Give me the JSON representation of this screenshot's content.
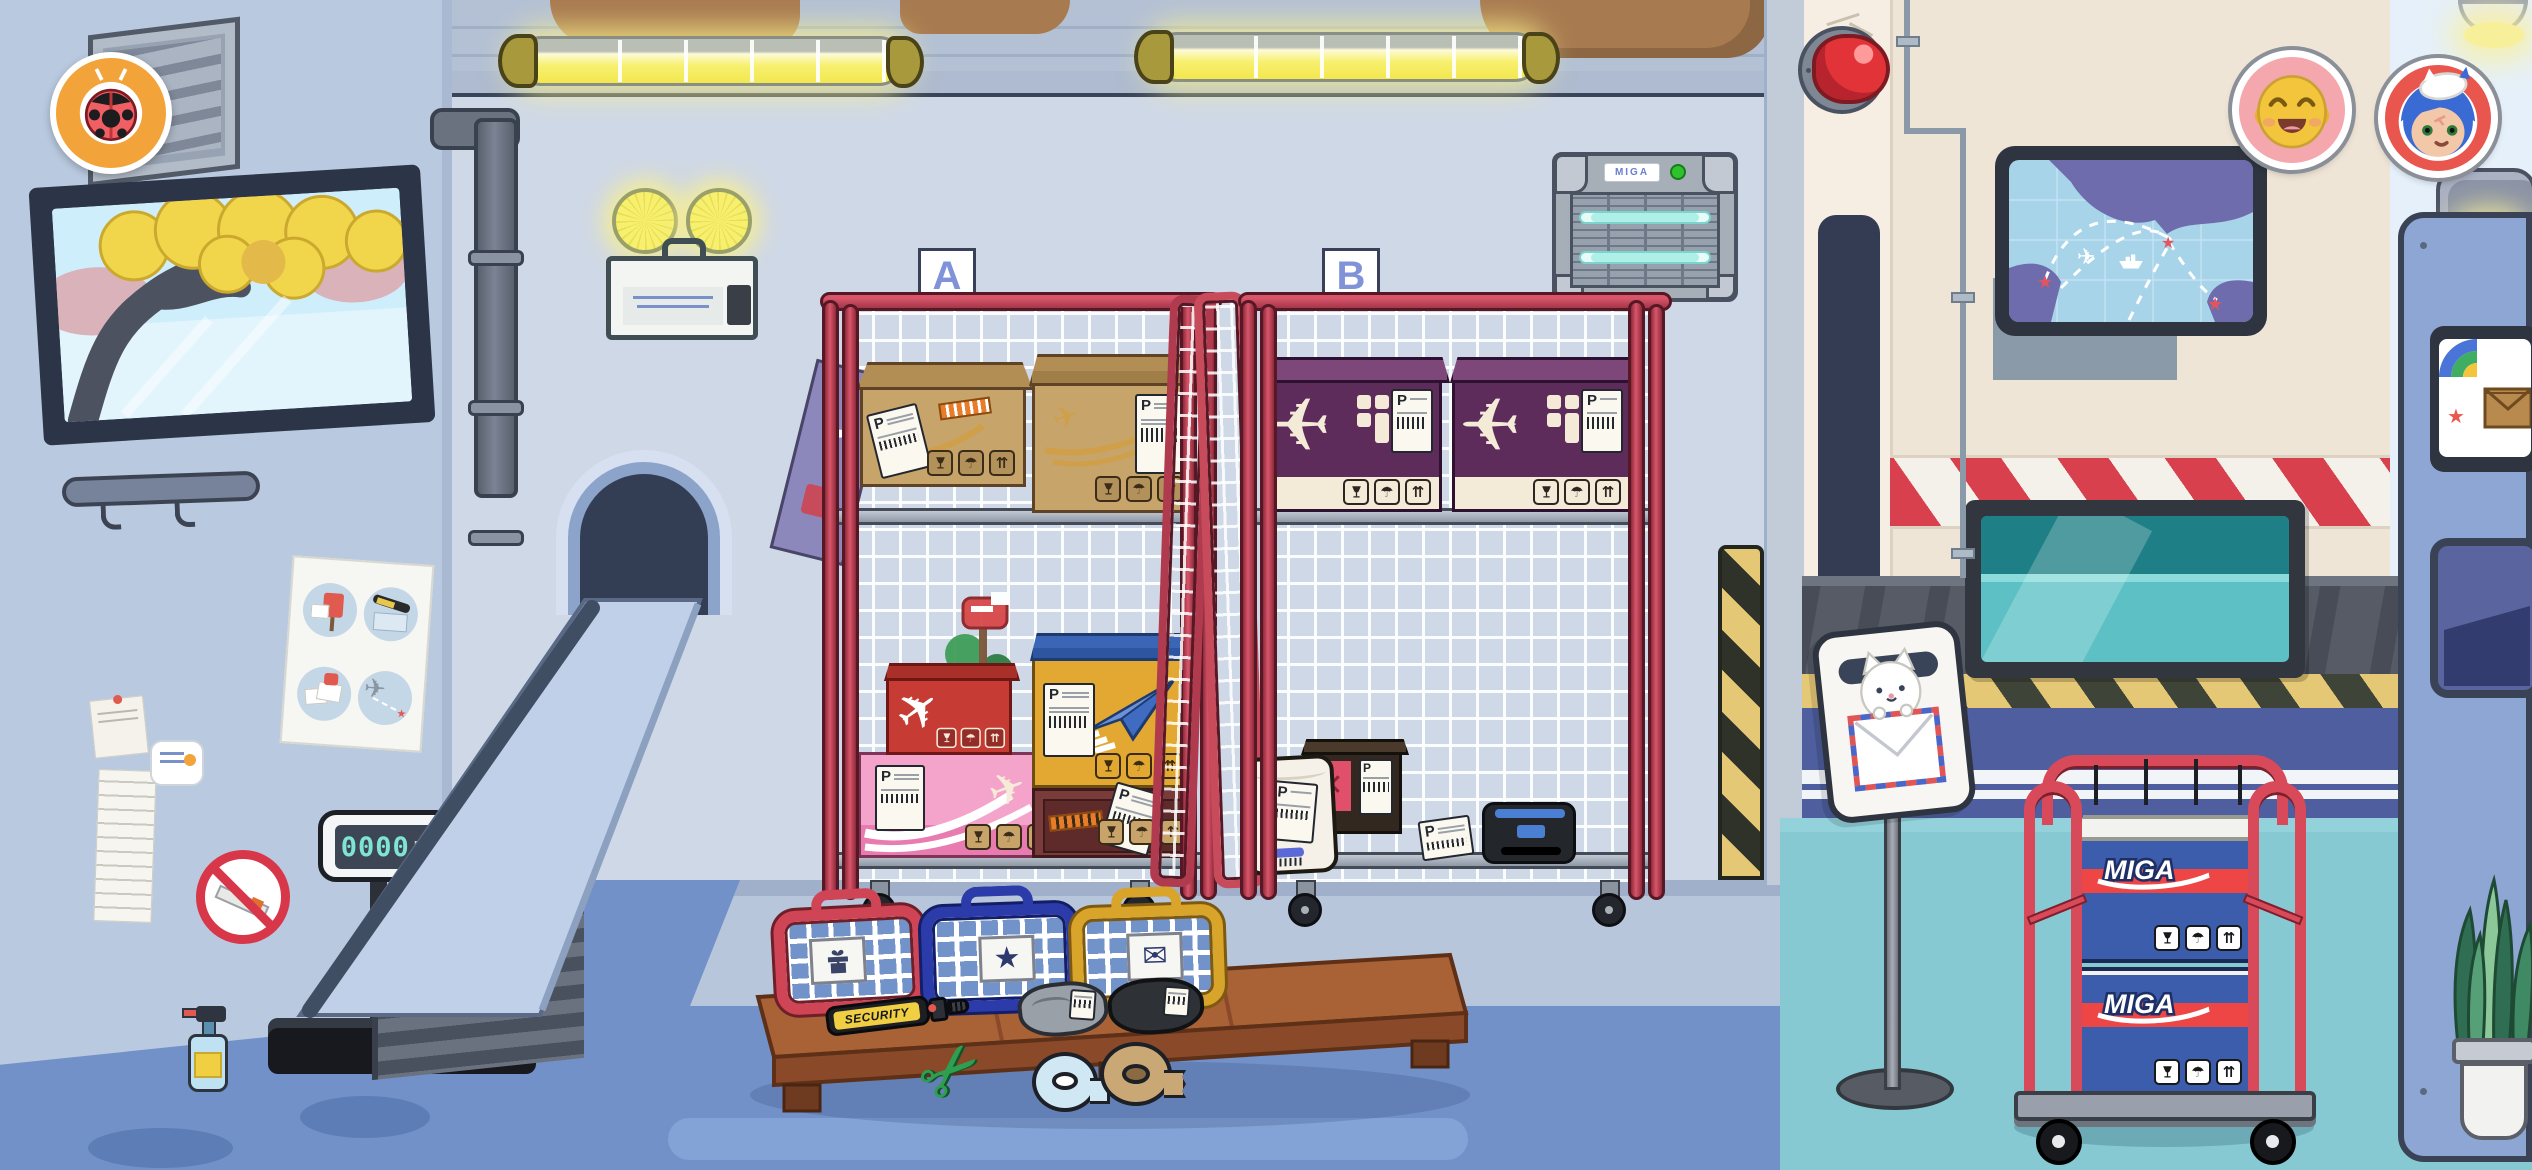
{
  "scene": {
    "title": "airport-mail-sorting-warehouse",
    "style": "cartoon-game"
  },
  "brand": {
    "miga": "MIGA"
  },
  "labels": {
    "parcel_letter": "P"
  },
  "hud": {
    "exit_button_icon": "ladybug-icon",
    "avatars": [
      {
        "id": "avatar-smiley",
        "bg": "#F5A7AE"
      },
      {
        "id": "avatar-blue-hair-cat-hat",
        "bg": "#E8564E"
      }
    ]
  },
  "cages": [
    {
      "label": "A"
    },
    {
      "label": "B"
    }
  ],
  "scale": {
    "value": "0000",
    "unit": "kg"
  },
  "wand": {
    "text": "SECURITY"
  },
  "carriers": [
    {
      "name": "red-carrier",
      "icon": "gift-icon",
      "color": "#D04556"
    },
    {
      "name": "blue-carrier",
      "icon": "star-icon",
      "color": "#2B3CAA"
    },
    {
      "name": "gold-carrier",
      "icon": "envelope-icon",
      "color": "#D9A42A"
    }
  ],
  "icons": {
    "umbrella": "☂",
    "arrows_up": "⇈",
    "star": "★",
    "envelope": "✉",
    "plane": "✈",
    "scissors": "✂",
    "x_mark": "✕"
  },
  "colors": {
    "cage_red": "#C64B60",
    "wall_back": "#CFD8E7",
    "wall_left": "#B9C9DF",
    "wall_cream": "#EFE5D7",
    "floor_blue": "#7291C9",
    "floor_teal": "#86C9D2",
    "hazard_red": "#D8404E",
    "box_purple": "#5E2C5A",
    "box_blue": "#3B5DAC",
    "accent_orange": "#F2A43B",
    "label_letter_blue": "#8093D8"
  }
}
